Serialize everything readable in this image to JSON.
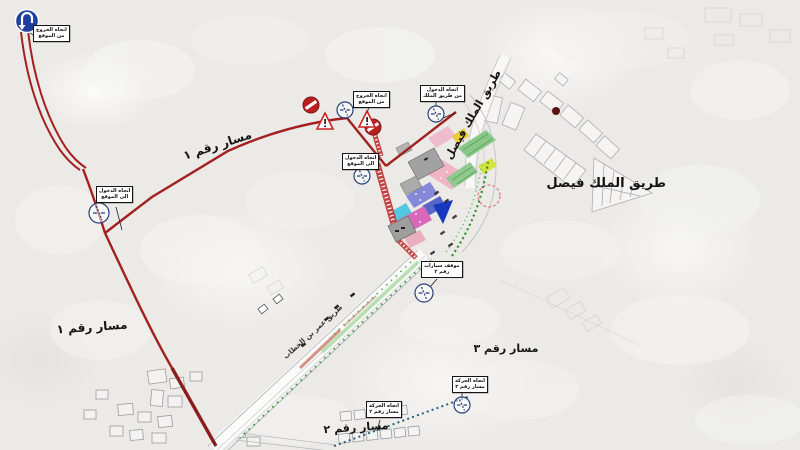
{
  "map": {
    "route_labels": {
      "route1_upper": "مسار رقم ١",
      "route1_lower": "مسار رقم ١",
      "route2": "مسار رقم ٢",
      "route3": "مسار رقم ٣"
    },
    "road_labels": {
      "king_faisal_bold": "طريق الملك فيصل",
      "king_faisal_diagonal": "طريق الملك فيصل",
      "omar_bin_alkhattab": "طريق عمر بن الخطاب"
    },
    "callouts": [
      {
        "line1": "اتجاه الخروج",
        "line2": "من الموقع"
      },
      {
        "line1": "اتجاه الدخول",
        "line2": "الى الموقع"
      },
      {
        "line1": "اتجاه الخروج",
        "line2": "من الموقع"
      },
      {
        "line1": "اتجاه الدخول",
        "line2": "الى الموقع"
      },
      {
        "line1": "اتجاه الدخول",
        "line2": "من طريق الملك"
      },
      {
        "line1": "موقف سيارات",
        "line2": "رقم ٢"
      },
      {
        "line1": "اتجاه الحركة",
        "line2": "مسار رقم ٢"
      },
      {
        "line1": "اتجاه الحركة",
        "line2": "مسار رقم ٣"
      }
    ],
    "icons": {
      "u_turn": "u-turn-sign",
      "no_entry": "no-entry-sign",
      "warning": "warning-triangle",
      "circle_marker": "traffic-circle-marker",
      "dot": "location-dot"
    },
    "colors": {
      "route1": "#a32020",
      "route1_dark": "#8c1c1c",
      "route2_dotted": "#2c5f73",
      "site_blue": "#1838c0",
      "background": "#ebeae7"
    }
  }
}
